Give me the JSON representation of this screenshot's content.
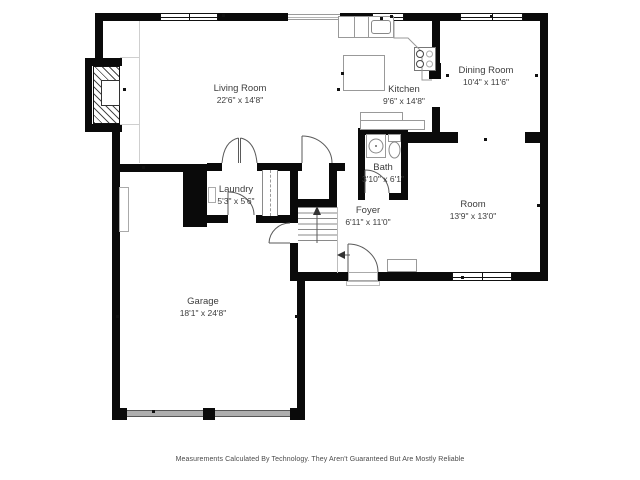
{
  "plan": {
    "rooms": {
      "living_room": {
        "name": "Living Room",
        "dimensions": "22'6\" x 14'8\""
      },
      "kitchen": {
        "name": "Kitchen",
        "dimensions": "9'6\" x 14'8\""
      },
      "dining_room": {
        "name": "Dining Room",
        "dimensions": "10'4\" x 11'6\""
      },
      "bath": {
        "name": "Bath",
        "dimensions": "3'10\" x 6'1\""
      },
      "laundry": {
        "name": "Laundry",
        "dimensions": "5'3\" x 5'6\""
      },
      "foyer": {
        "name": "Foyer",
        "dimensions": "6'11\" x 11'0\""
      },
      "room": {
        "name": "Room",
        "dimensions": "13'9\" x 13'0\""
      },
      "garage": {
        "name": "Garage",
        "dimensions": "18'1\" x 24'8\""
      }
    },
    "disclaimer": "Measurements Calculated By Technology. They Aren't Guaranteed But Are Mostly Reliable",
    "colors": {
      "wall": "#0a0a0a",
      "background": "#ffffff",
      "garage_door": "#aeaeae",
      "fixture_outline": "#999999",
      "label_text": "#3d3d3d"
    }
  }
}
